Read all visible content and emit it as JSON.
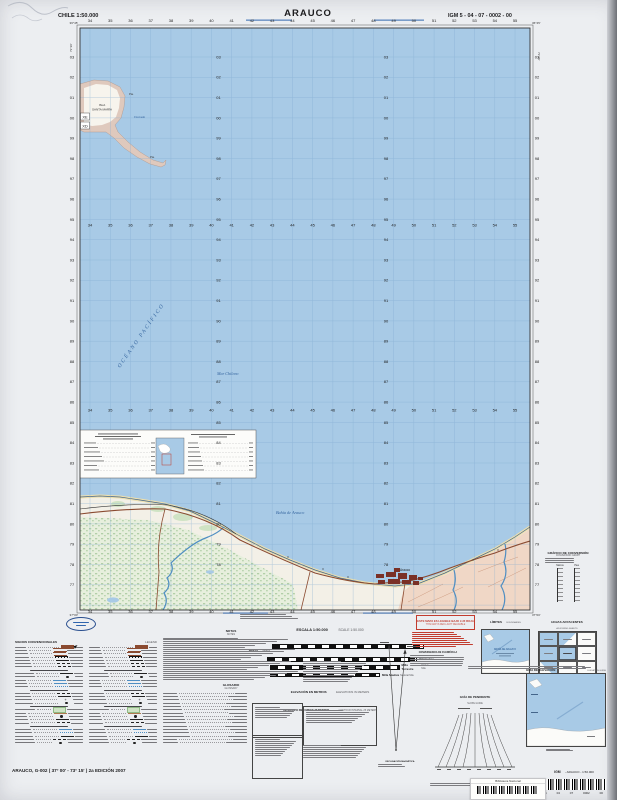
{
  "header": {
    "scale_note": "CHILE  1:50.000",
    "title": "ARAUCO",
    "sheet_id": "IGM 5 - 04 - 07 - 0002 - 00"
  },
  "map": {
    "eastings": [
      "34",
      "35",
      "36",
      "37",
      "38",
      "39",
      "40",
      "41",
      "42",
      "43",
      "44",
      "45",
      "46",
      "47",
      "48",
      "49",
      "50",
      "51",
      "52",
      "53",
      "54",
      "55"
    ],
    "northings": [
      "03",
      "02",
      "01",
      "00",
      "99",
      "98",
      "97",
      "96",
      "95",
      "94",
      "93",
      "92",
      "91",
      "90",
      "89",
      "88",
      "87",
      "86",
      "85",
      "84",
      "83",
      "82",
      "81",
      "80",
      "79",
      "78",
      "77"
    ],
    "corners": {
      "top_left": "36°45'",
      "top_right": "36°45'",
      "bottom_left": "37°00'",
      "bottom_right": "37°00'",
      "lon_west": "73°30'",
      "lon_east": "73°15'"
    },
    "labels": {
      "ocean": "OCÉANO  PACÍFICO",
      "sea": "Mar  Chileno",
      "bay": "Bahía  de  Arauco",
      "island_1": "ISLA",
      "island_2": "SANTA MARÍA",
      "ensenada": "Ensenada",
      "point_ne": "Pta.",
      "point_spit": "Pta.",
      "town": "Arauco",
      "grid_xe": "XE",
      "grid_xd": "XD"
    },
    "colors": {
      "ocean": "#a8cae6",
      "grid": "#7fa9cf",
      "land": "#f3f0e7",
      "island_band": "#dfc9bd",
      "pink_terrain": "#f0d7c6",
      "marsh_dot": "#8fba85",
      "town": "#7a3026",
      "road": "#8a4a30",
      "river": "#4f8ec2",
      "sand": "#ecdfae"
    }
  },
  "scale_block": {
    "title_es": "ESCALA 1:50.000",
    "title_en": "SCALE 1:50.000",
    "bar1_left_es": "Metros",
    "bar1_left_en": "Meters",
    "bar2_right_es": "Kilómetros",
    "bar3_right_es": "Milla Terrestre",
    "bar3_right_en": "Statute Mile",
    "bar4_right_es": "Milla Náutica",
    "bar4_right_en": "Nautical Mile",
    "elev_es": "ELEVACIÓN EN METROS",
    "elev_en": "ELEVATIONS IN METERS",
    "interval_es": "INTERVALO DE CURVAS 25 METROS",
    "interval_en": "CONTOUR INTERVAL 25 METERS"
  },
  "legend": {
    "title_es": "SIGNOS CONVENCIONALES",
    "title_en": "LEGEND"
  },
  "notes": {
    "title_es": "NOTAS",
    "title_en": "NOTES"
  },
  "glossary": {
    "title_es": "GLOSARIO",
    "title_en": "GLOSSARY"
  },
  "red_notice": {
    "line1": "ESTE MAPA ES LEGIBLE BAJO LUZ ROJA",
    "line2": "THIS MAP IS RED-LIGHT READABLE"
  },
  "declination": {
    "caption": "DECLINACIÓN MAGNÉTICA"
  },
  "convergence": {
    "caption": "CONVERGENCIA DE CUADRÍCULA"
  },
  "conversion": {
    "title_es": "GRÁFICO DE CONVERSIÓN",
    "title_en": "CONVERSION GRAPH",
    "unit_left": "Metros",
    "unit_right": "Pies"
  },
  "limits": {
    "title_es": "LÍMITES",
    "title_en": "BOUNDARIES",
    "map_label": "BAHÍA DE ARAUCO"
  },
  "adjoining": {
    "title_es": "HOJAS ADYACENTES",
    "title_en": "ADJOINING SHEETS"
  },
  "slope": {
    "title_es": "GUÍA DE PENDIENTE",
    "title_en": "SLOPE GUIDE"
  },
  "elevation_guide": {
    "title_es": "GUÍA DE ELEVACIÓN",
    "title_en": "ELEVATION GUIDE"
  },
  "identification": {
    "igm": "IGM",
    "map_ref": "- ARAUCO -  1:50.000",
    "barcode_digits": [
      "5",
      "04",
      "07",
      "0002",
      "00"
    ],
    "sticker": "Biblioteca Nacional"
  },
  "sheet_note": "ARAUCO, G-002  ( 37° 00' - 73° 15' )  2a EDICIÓN 2007"
}
